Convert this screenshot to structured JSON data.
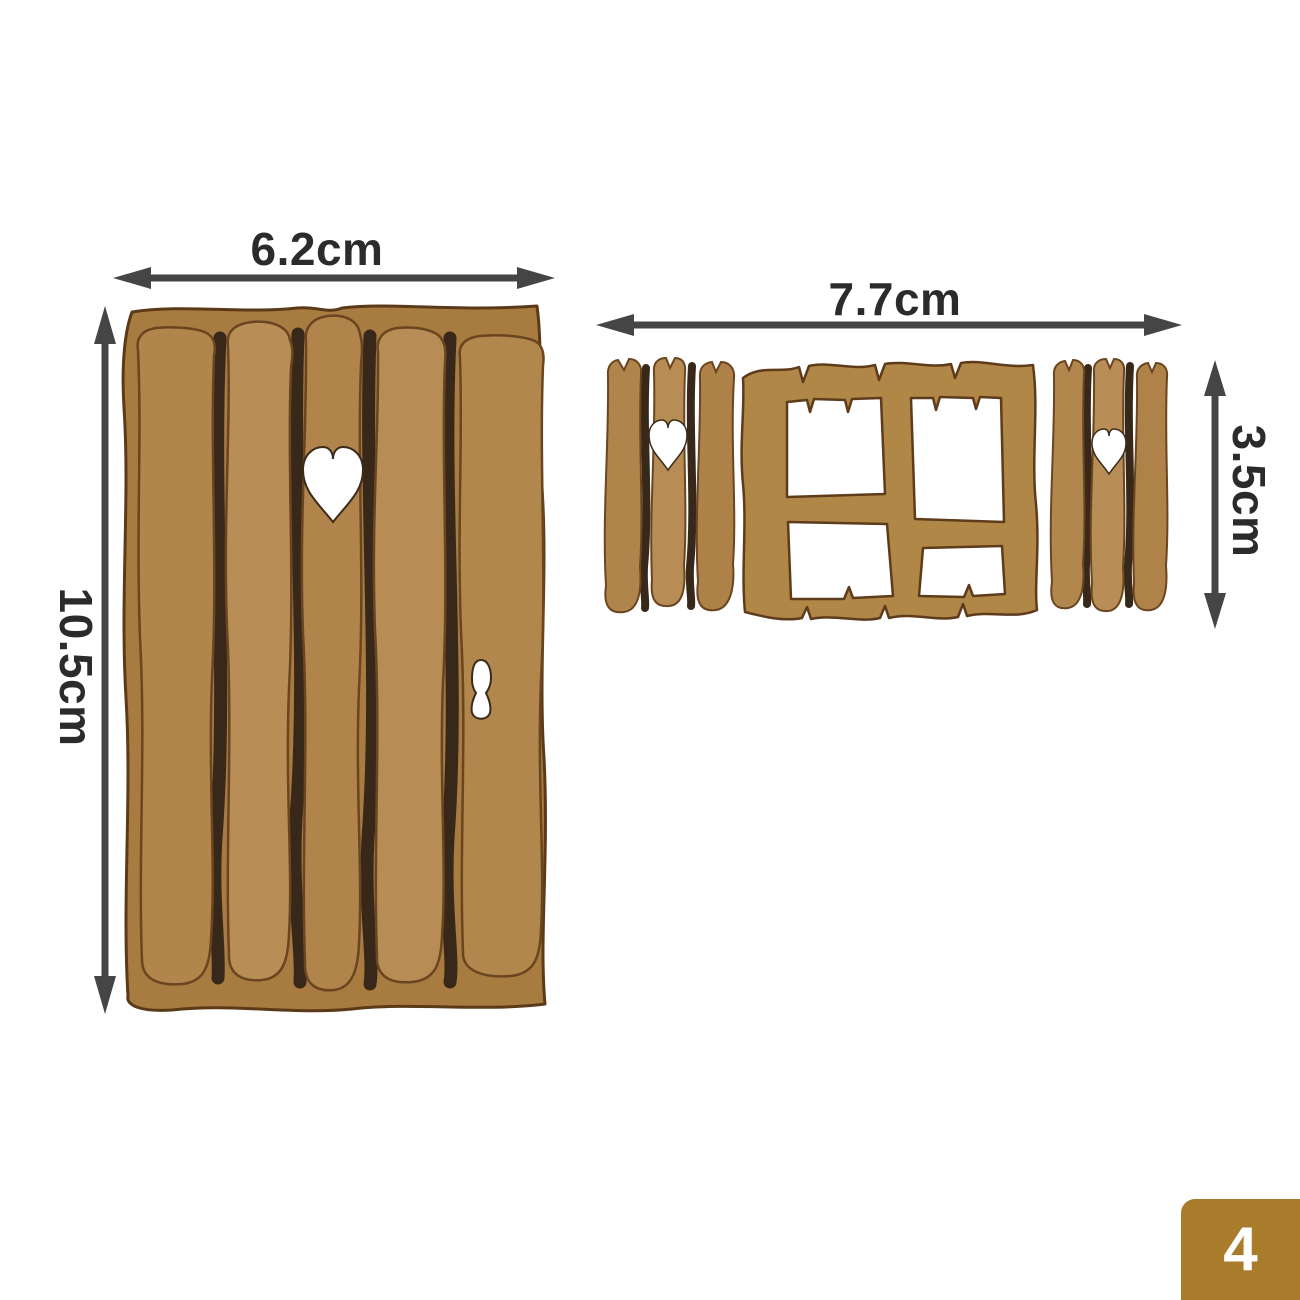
{
  "image_type": "product dimension photo of MDF fairy door and window craft pieces",
  "door": {
    "name": "plank fairy door with heart and keyhole cutouts",
    "width_label": "6.2cm",
    "height_label": "10.5cm",
    "plank_count": 5,
    "cutouts": [
      "heart",
      "keyhole"
    ]
  },
  "window_set": {
    "name": "four-pane window with two heart shutters",
    "width_label": "7.7cm",
    "height_label": "3.5cm",
    "pieces": [
      "left shutter with heart",
      "four-pane window frame",
      "right shutter with heart"
    ]
  },
  "badge": {
    "value": "4"
  },
  "colors": {
    "background": "#ffffff",
    "wood_base": "#b1854b",
    "wood_light": "#b88e56",
    "wood_backing": "#a87b41",
    "wood_outline": "#5c3a18",
    "gap_shadow": "#38281a",
    "cutout_fill": "#ffffff",
    "arrow": "#454545",
    "label_text": "#2b2b2b",
    "badge_bg": "#a87c2b",
    "badge_text": "#ffffff"
  }
}
